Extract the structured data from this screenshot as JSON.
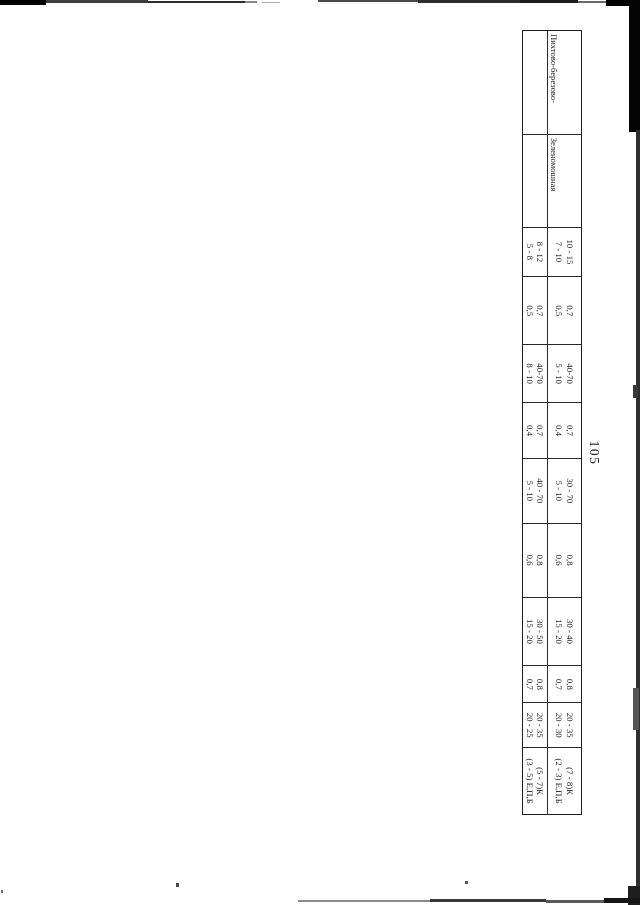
{
  "page": {
    "number": "105"
  },
  "colors": {
    "paper": "#ffffff",
    "ink": "#1b1b1b",
    "table_line": "#2a2a2a"
  },
  "table": {
    "orientation": "rotated-90-clockwise",
    "rows": [
      {
        "cells": [
          {
            "lines": [
              "Пихтово-березово-",
              "осиновые (елово-пихто-",
              "вые) с кедром"
            ]
          },
          {
            "lines": [
              "Зеленомошная",
              "(II - IV)"
            ]
          },
          {
            "lines": [
              "10 - 15",
              "7 - 10"
            ]
          },
          {
            "lines": [
              "0,7",
              "0,5"
            ]
          },
          {
            "lines": [
              "40-70",
              "5 - 10"
            ]
          },
          {
            "lines": [
              "0,7",
              "0,4"
            ]
          },
          {
            "lines": [
              "30 - 70",
              "5 - 10"
            ]
          },
          {
            "lines": [
              "0,8",
              "0,6"
            ]
          },
          {
            "lines": [
              "30 - 40",
              "15 - 20"
            ]
          },
          {
            "lines": [
              "0,8",
              "0,7"
            ]
          },
          {
            "lines": [
              "20 - 35",
              "20 - 30"
            ]
          },
          {
            "lines": [
              "(7 - 8)К",
              "(2 - 3) Е,П,Б"
            ]
          }
        ]
      },
      {
        "cells": [
          {
            "lines": [
              "Березово-осиновые    с",
              "пихтой и кедром"
            ]
          },
          {
            "lines": [
              "Травяная",
              "(I - III)"
            ]
          },
          {
            "lines": [
              "8 - 12",
              "5 - 8"
            ]
          },
          {
            "lines": [
              "0,7",
              "0,5"
            ]
          },
          {
            "lines": [
              "40-70",
              "8 - 10"
            ]
          },
          {
            "lines": [
              "0,7",
              "0,4"
            ]
          },
          {
            "lines": [
              "40 - 70",
              "5 - 10"
            ]
          },
          {
            "lines": [
              "0,8",
              "0,6"
            ]
          },
          {
            "lines": [
              "30 - 50",
              "15 - 20"
            ]
          },
          {
            "lines": [
              "0,8",
              "0,7"
            ]
          },
          {
            "lines": [
              "20 - 35",
              "20 - 25"
            ]
          },
          {
            "lines": [
              "(5 - 7)К",
              "(3 - 5) Е,П,Б"
            ]
          }
        ]
      }
    ]
  }
}
